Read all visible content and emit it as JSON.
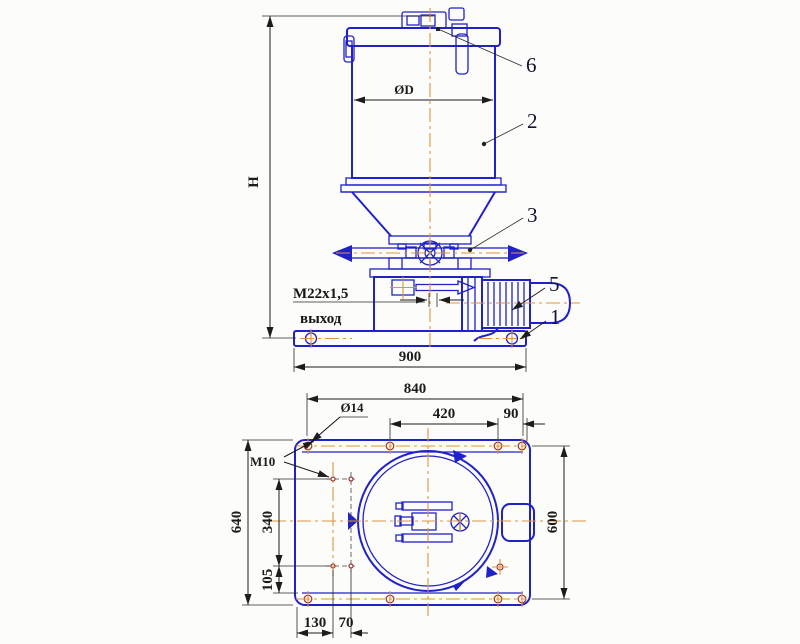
{
  "colors": {
    "geometry": "#2121c8",
    "centerline": "#dd9440",
    "dimension": "#1c1c1c",
    "label": "#121232",
    "background": "#fcfcfa",
    "hole_mark": "#a03030"
  },
  "front_view": {
    "dim_overall_height": "H",
    "dim_reservoir_diameter": "ØD",
    "thread_callout": "М22х1,5",
    "outlet_label": "выход",
    "dim_base_width": "900",
    "ref_base_plate": "1",
    "ref_reservoir": "2",
    "ref_distributor": "3",
    "ref_motor": "5",
    "ref_filler_cap": "6"
  },
  "plan_view": {
    "dim_hole_span_x": "840",
    "dim_hole_pitch": "420",
    "dim_hole_edge": "90",
    "dim_plate_width": "640",
    "dim_pattern_height": "340",
    "dim_pattern_offset": "105",
    "dim_hole_span_y": "600",
    "dim_pattern_left": "130",
    "dim_pattern_pitch": "70",
    "callout_hole_diameter": "Ø14",
    "callout_tapped_hole": "M10"
  }
}
